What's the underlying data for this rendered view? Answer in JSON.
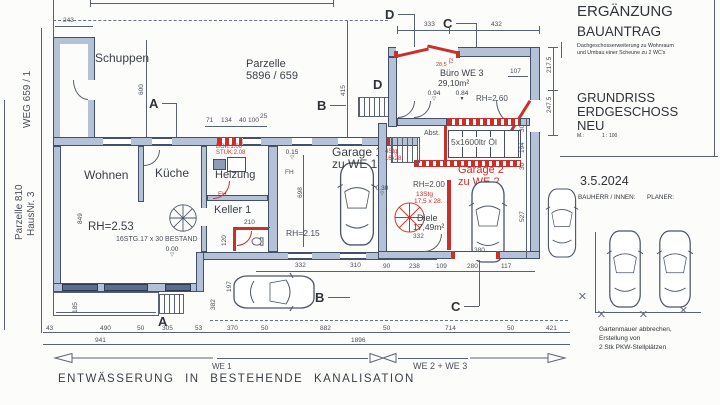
{
  "colors": {
    "wall_fill": "#b4c1d6",
    "new_red": "#c9302a",
    "line": "#5a6270"
  },
  "site": {
    "weg": "WEG 659 / 1",
    "parz_l1": "Parzelle 810",
    "parz_l2": "HausNr. 3",
    "parz_m1": "Parzelle",
    "parz_m2": "5896 / 659"
  },
  "rooms": {
    "schuppen": "Schuppen",
    "wohnen": "Wohnen",
    "kueche": "Küche",
    "heizung": "Heizung",
    "keller": "Keller 1",
    "garage1a": "Garage 1",
    "garage1b": "zu WE 1",
    "buero_a": "Büro WE 3",
    "buero_b": "29,10m²",
    "abst": "Abst.",
    "oil": "5x1600ltr Öl",
    "garage2a": "Garage 2",
    "garage2b": "zu WE 2",
    "diele_a": "Diele",
    "diele_b": "17,49m²"
  },
  "annot": {
    "rh253": "RH=2.53",
    "rh215": "RH=2.15",
    "rh200": "RH=2.00",
    "rh260": "RH=2.60",
    "bestand": "16STG.17 x 30 BESTAND",
    "bok": "BOK:1.00",
    "stuk": "STUK:2.08",
    "fh_a": "FH",
    "fh_b": "FH",
    "stg4a": "4Stg",
    "stg4b": "16x28",
    "stg13a": "13Stg",
    "stg13b": "17,5 x 28.",
    "l000": "0.00",
    "l015": "0.15",
    "l030": "0.30",
    "l084": "0.84",
    "l094": "0.94",
    "tri_open": "▽",
    "tri_fill": "▼"
  },
  "markers": {
    "a": "A",
    "b": "B",
    "c": "C",
    "d": "D"
  },
  "dims": {
    "d243": "243",
    "d600": "600",
    "d415": "415",
    "d333": "333",
    "d432": "432",
    "d72": "72",
    "d285": "28,5",
    "d107": "107",
    "d2175": "217.5",
    "d2475": "247.5",
    "d194": "194",
    "d30a": "30",
    "d30b": "30",
    "d527": "527",
    "d71": "71",
    "d134": "134",
    "d40": "40",
    "d100": "100",
    "d25": "25",
    "d210": "210",
    "d120": "120",
    "d698": "698",
    "d849": "849",
    "d332a": "332",
    "d310": "310",
    "d197": "197",
    "d382": "382",
    "d332b": "332",
    "d380": "380",
    "d90": "90",
    "d238": "238",
    "d109": "109",
    "d280": "280",
    "d117": "117",
    "b43": "43",
    "b490": "490",
    "b50a": "50",
    "b305": "305",
    "b53": "53",
    "b370": "370",
    "b50b": "50",
    "b882": "882",
    "b50c": "50",
    "b714": "714",
    "b50d": "50",
    "b421": "421",
    "t941": "941",
    "t1896": "1896",
    "d185": "185"
  },
  "bottom": {
    "we1": "WE 1",
    "we23": "WE 2 + WE 3",
    "drainage": "ENTWÄSSERUNG IN BESTEHENDE KANALISATION"
  },
  "title_block": {
    "t1": "ERGÄNZUNG",
    "t2": "BAUANTRAG",
    "s1": "Dachgeschosserweiterung zu Wohnraum",
    "s2": "und Umbau einer Scheune zu 2 WC's",
    "g1": "GRUNDRISS",
    "g2": "ERDGESCHOSS",
    "g3": "NEU",
    "scale_k": "M.:",
    "scale_v": "1 : 100",
    "date": "3.5.2024",
    "bauherr": "BAUHERR / INNEN:",
    "planer": "PLANER:",
    "n1": "Gartenmauer abbrechen,",
    "n2": "Erstellung von",
    "n3": "2 Stk PKW-Stellplätzen"
  }
}
